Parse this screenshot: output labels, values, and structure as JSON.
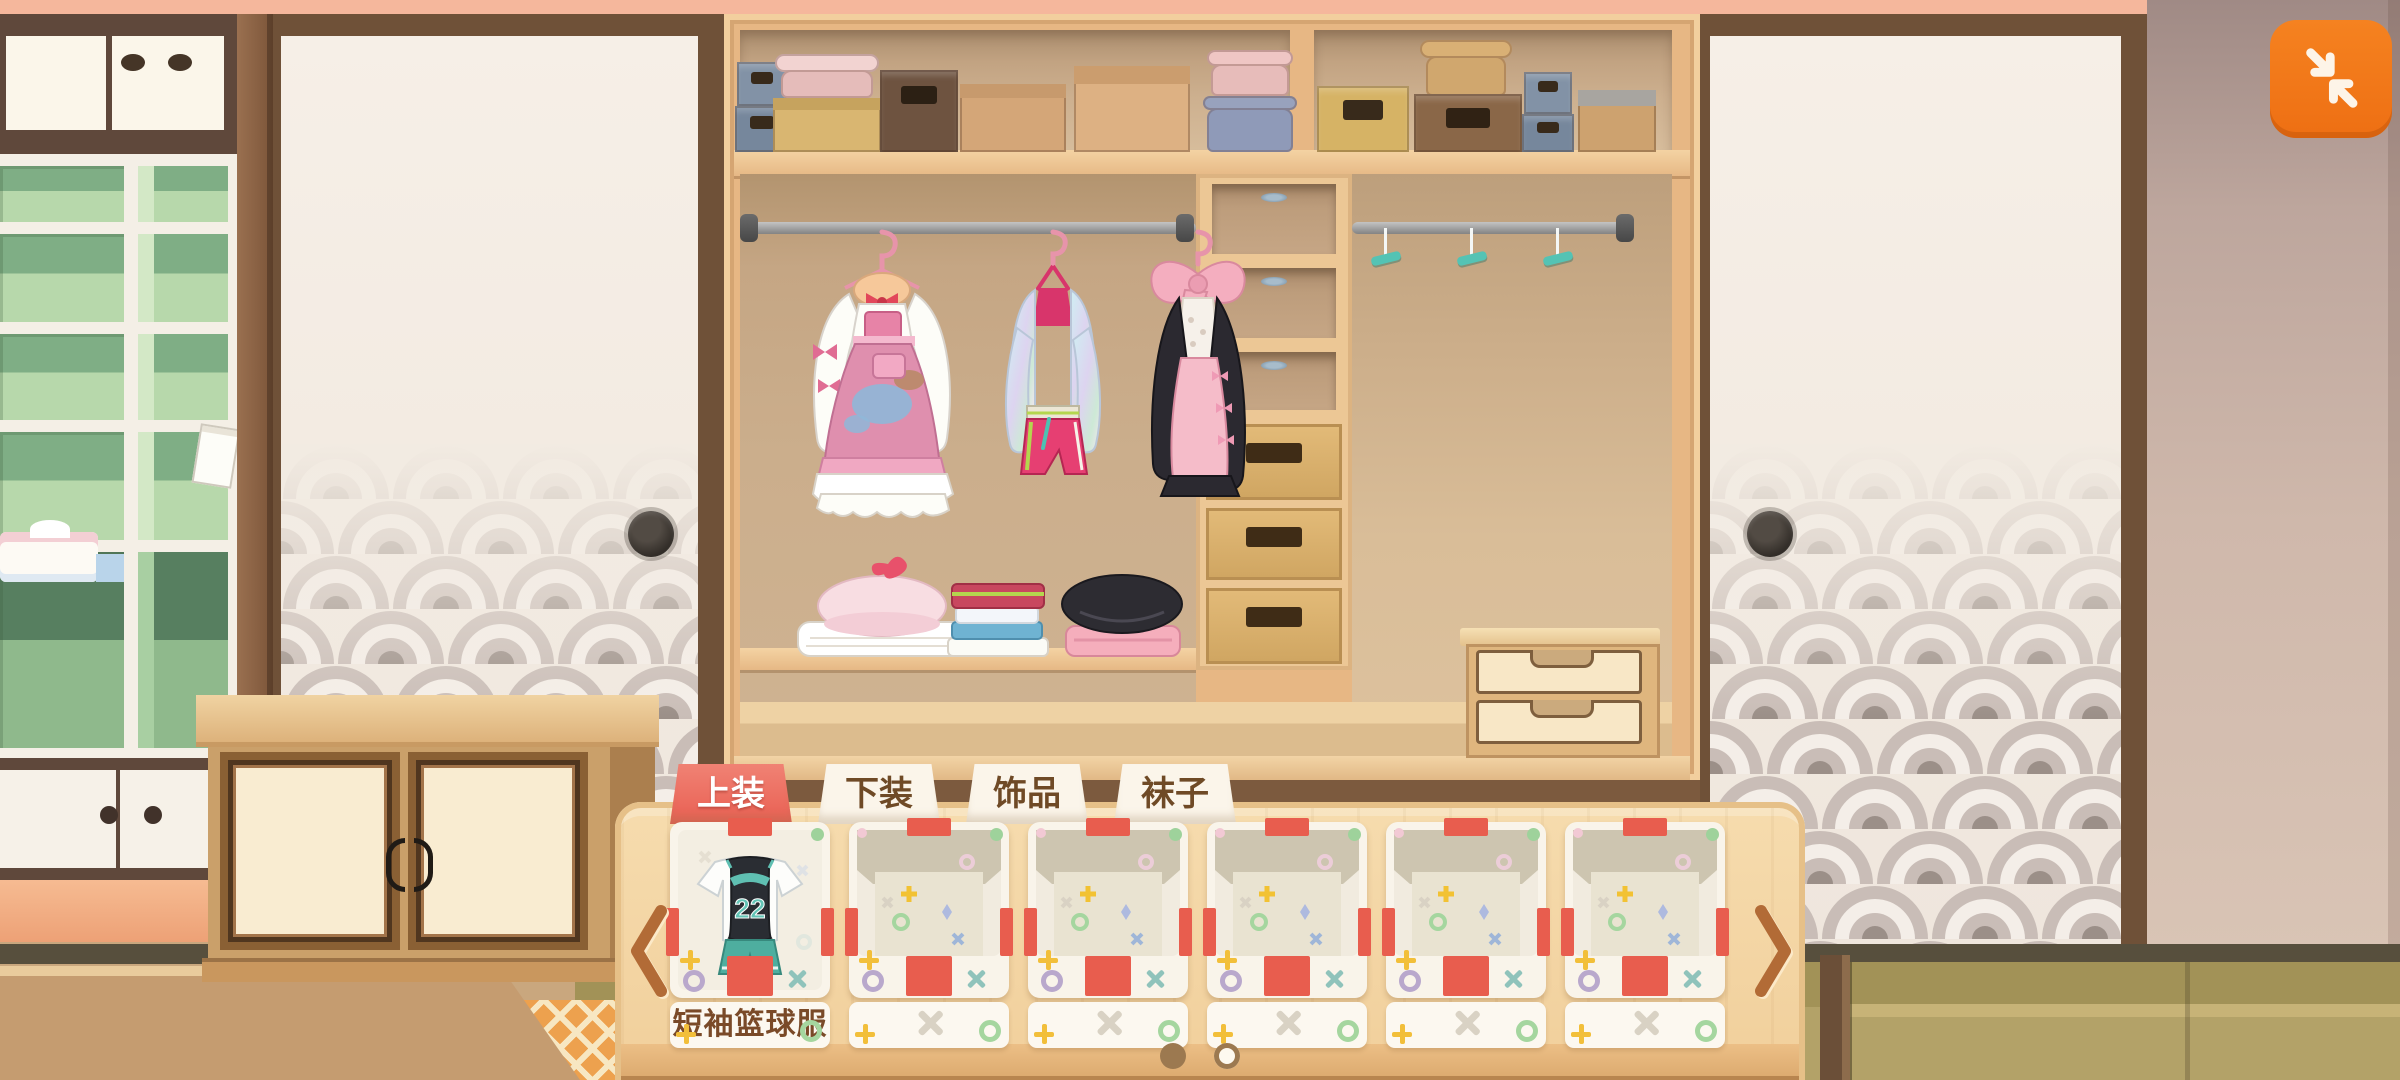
{
  "window": {
    "collapse_button_icon": "collapse-arrows"
  },
  "tabs": [
    {
      "label": "上装",
      "active": true
    },
    {
      "label": "下装",
      "active": false
    },
    {
      "label": "饰品",
      "active": false
    },
    {
      "label": "袜子",
      "active": false
    }
  ],
  "carousel": {
    "prev_icon": "chevron-left",
    "next_icon": "chevron-right",
    "items": [
      {
        "name": "短袖篮球服",
        "art": "basketball-jersey",
        "jersey_number": "22",
        "filled": true
      },
      {
        "name": "",
        "art": "empty-box",
        "filled": false
      },
      {
        "name": "",
        "art": "empty-box",
        "filled": false
      },
      {
        "name": "",
        "art": "empty-box",
        "filled": false
      },
      {
        "name": "",
        "art": "empty-box",
        "filled": false
      },
      {
        "name": "",
        "art": "empty-box",
        "filled": false
      }
    ],
    "pagination": {
      "total": 2,
      "current_page": 1
    }
  },
  "wardrobe": {
    "hanging_outfits": [
      "pink-lolita-dress",
      "iridescent-jacket-set",
      "black-pink-dress"
    ],
    "empty_hangers": 3,
    "shelf_items": [
      "pink-beret",
      "folded-clothes-stack",
      "black-beret"
    ],
    "floor_items": [
      "white-socks",
      "gray-beret"
    ],
    "storage": [
      "top-shelf-boxes",
      "three-cubbies",
      "three-drawers",
      "two-drawer-chest"
    ]
  },
  "colors": {
    "accent_orange": "#f0761b",
    "tab_active_red": "#ec695b",
    "tape_red": "#e85d4e",
    "panel_wood": "#f3d6a4",
    "label_text_brown": "#7a4a28"
  }
}
